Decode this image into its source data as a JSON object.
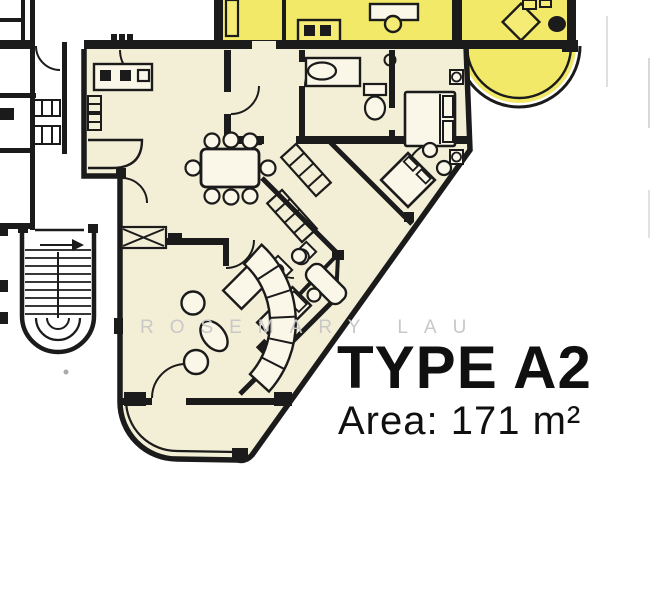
{
  "plan": {
    "title": "TYPE A2",
    "area_label": "Area: 171 m²",
    "watermark": "ROSEMARY LAU"
  },
  "colors": {
    "background": "#FFFFFF",
    "floor_fill": "#F3EED6",
    "highlight_fill": "#F2E968",
    "wall": "#1B1B1B",
    "watermark_gray": "#C8C8C8",
    "text": "#101010"
  }
}
